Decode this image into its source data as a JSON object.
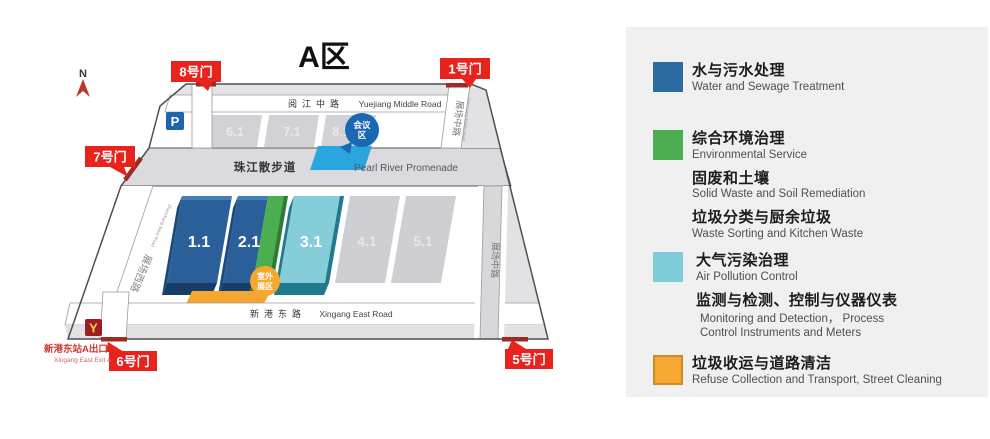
{
  "map": {
    "title": "A区",
    "north_label": "N",
    "parking_label": "P",
    "conference": {
      "line1": "会议",
      "line2": "区"
    },
    "outdoor": {
      "line1": "室外",
      "line2": "展区"
    },
    "halls_top": [
      "6.1",
      "7.1",
      "8.1"
    ],
    "halls_main": [
      "1.1",
      "2.1",
      "3.1",
      "4.1",
      "5.1"
    ],
    "gates": {
      "g8": "8号门",
      "g1": "1号门",
      "g7": "7号门",
      "g6": "6号门",
      "g5": "5号门"
    },
    "roads": {
      "yuejiang_cn": "阅江中路",
      "yuejiang_en": "Yuejiang Middle Road",
      "promenade_cn": "珠江散步道",
      "promenade_en": "Pearl River Promenade",
      "xingang_cn": "新港东路",
      "xingang_en": "Xingang East Road",
      "zhanchang_west_cn": "展场西路",
      "zhanchang_west_en": "Zhanchang West Road",
      "zhanchang_middle_top_cn": "展场中路",
      "zhanchang_middle_top_en": "Zhanchang Middle Road",
      "zhanchang_middle_right_cn": "展场中路"
    },
    "metro": {
      "logo": "Y",
      "exit_cn": "新港东站A出口",
      "exit_en": "Xingang East  Exit A"
    }
  },
  "colors": {
    "hall_blue": "#2a5f99",
    "hall_blue_dark": "#173c68",
    "hall_blue_side": "#1d4a7c",
    "hall_blue_bevel": "#4a7db3",
    "hall_green": "#4bae50",
    "hall_green_dark": "#2e7d36",
    "hall_cyan": "#85cdd9",
    "hall_cyan_dark": "#1f7a8c",
    "conference_blue": "#1a67b2",
    "promenade_strip_blue": "#2aa5dd",
    "outdoor_orange": "#f6a72f",
    "gate_label_red": "#e8231e",
    "gate_dash_red": "#9e2b22",
    "metro_red": "#9c1d22",
    "metro_yellow": "#f8d24a",
    "parking_blue": "#1e63ad",
    "north_arrow_red": "#b8382c"
  },
  "legend": {
    "items": [
      {
        "color": "#2d6ca3",
        "lines": [
          {
            "cn": "水与污水处理",
            "en": "Water and Sewage Treatment"
          }
        ]
      },
      {
        "color": "#4bae50",
        "lines": [
          {
            "cn": "综合环境治理",
            "en": "Environmental Service"
          },
          {
            "cn": "固废和土壤",
            "en": "Solid Waste and Soil Remediation"
          },
          {
            "cn": "垃圾分类与厨余垃圾",
            "en": "Waste Sorting and Kitchen Waste"
          }
        ]
      },
      {
        "color": "#7ecbd9",
        "lines": [
          {
            "cn": "大气污染治理",
            "en": "Air Pollution Control"
          },
          {
            "cn": "监测与检测、控制与仪器仪表",
            "en": "Monitoring and Detection， Process",
            "en2": "Control Instruments and Meters"
          }
        ]
      },
      {
        "color": "#f7a833",
        "lines": [
          {
            "cn": "垃圾收运与道路清洁",
            "en": "Refuse Collection and Transport, Street Cleaning"
          }
        ]
      }
    ]
  }
}
